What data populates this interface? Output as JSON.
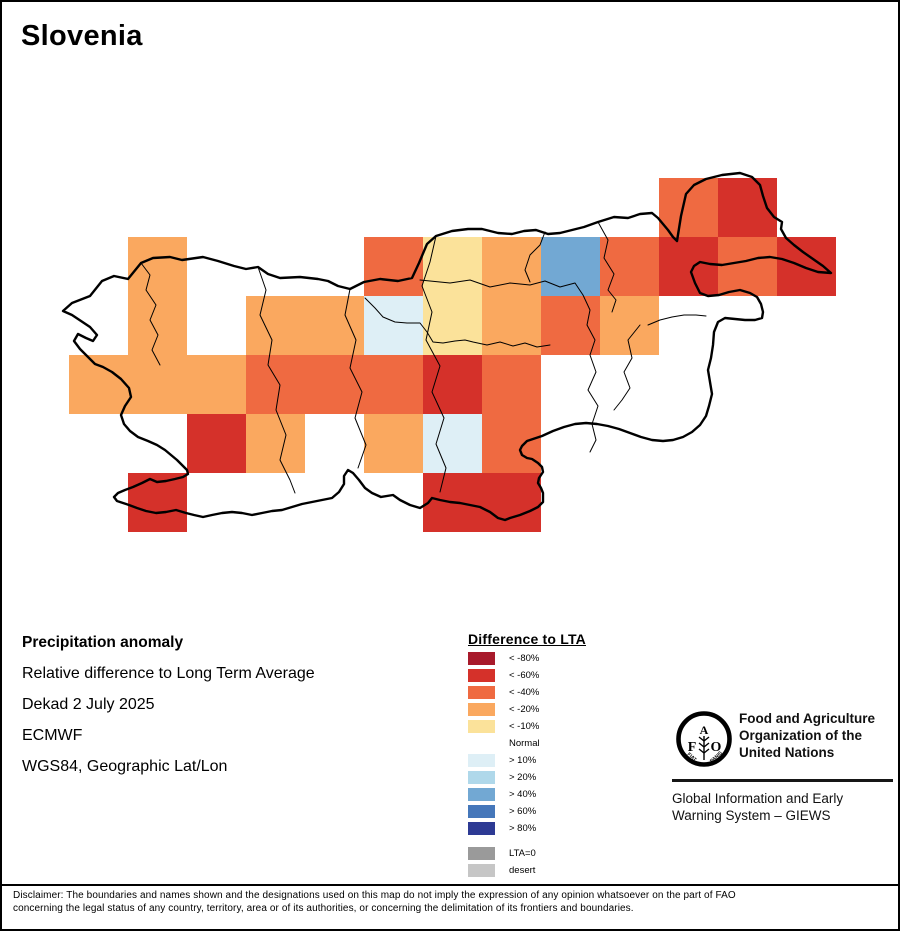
{
  "title": "Slovenia",
  "info": {
    "heading": "Precipitation anomaly",
    "subtitle": "Relative difference to Long Term Average",
    "dekad": "Dekad 2 July 2025",
    "source": "ECMWF",
    "projection": "WGS84, Geographic Lat/Lon"
  },
  "legend": {
    "title": "Difference to LTA",
    "items": [
      {
        "label": "< -80%",
        "class": "lt80"
      },
      {
        "label": "< -60%",
        "class": "lt60"
      },
      {
        "label": "< -40%",
        "class": "lt40"
      },
      {
        "label": "< -20%",
        "class": "lt20"
      },
      {
        "label": "< -10%",
        "class": "lt10"
      },
      {
        "label": "Normal",
        "class": "normal"
      },
      {
        "label": "> 10%",
        "class": "gt10"
      },
      {
        "label": "> 20%",
        "class": "gt20"
      },
      {
        "label": "> 40%",
        "class": "gt40"
      },
      {
        "label": "> 60%",
        "class": "gt60"
      },
      {
        "label": "> 80%",
        "class": "gt80"
      },
      {
        "label": "LTA=0",
        "class": "lta0",
        "gap_before": true
      },
      {
        "label": "desert",
        "class": "desert"
      }
    ]
  },
  "palette": {
    "lt80": "#A81A2B",
    "lt60": "#D5312A",
    "lt40": "#EF6A41",
    "lt20": "#FAA85F",
    "lt10": "#FBE29A",
    "normal": null,
    "gt10": "#DEEFF6",
    "gt20": "#AFD8EA",
    "gt40": "#72A8D3",
    "gt60": "#4577BA",
    "gt80": "#2D3A94",
    "lta0": "#9A9A9A",
    "desert": "#C6C6C6"
  },
  "map": {
    "cells": [
      {
        "col": 11,
        "row": 1,
        "class": "lt40"
      },
      {
        "col": 12,
        "row": 1,
        "class": "lt60"
      },
      {
        "col": 2,
        "row": 2,
        "class": "lt20"
      },
      {
        "col": 6,
        "row": 2,
        "class": "lt40"
      },
      {
        "col": 7,
        "row": 2,
        "class": "lt10"
      },
      {
        "col": 8,
        "row": 2,
        "class": "lt20"
      },
      {
        "col": 9,
        "row": 2,
        "class": "gt40"
      },
      {
        "col": 10,
        "row": 2,
        "class": "lt40"
      },
      {
        "col": 11,
        "row": 2,
        "class": "lt60"
      },
      {
        "col": 12,
        "row": 2,
        "class": "lt40"
      },
      {
        "col": 13,
        "row": 2,
        "class": "lt60"
      },
      {
        "col": 2,
        "row": 3,
        "class": "lt20"
      },
      {
        "col": 4,
        "row": 3,
        "class": "lt20"
      },
      {
        "col": 5,
        "row": 3,
        "class": "lt20"
      },
      {
        "col": 6,
        "row": 3,
        "class": "gt10"
      },
      {
        "col": 7,
        "row": 3,
        "class": "lt10"
      },
      {
        "col": 8,
        "row": 3,
        "class": "lt20"
      },
      {
        "col": 9,
        "row": 3,
        "class": "lt40"
      },
      {
        "col": 10,
        "row": 3,
        "class": "lt20"
      },
      {
        "col": 1,
        "row": 4,
        "class": "lt20"
      },
      {
        "col": 2,
        "row": 4,
        "class": "lt20"
      },
      {
        "col": 3,
        "row": 4,
        "class": "lt20"
      },
      {
        "col": 4,
        "row": 4,
        "class": "lt40"
      },
      {
        "col": 5,
        "row": 4,
        "class": "lt40"
      },
      {
        "col": 6,
        "row": 4,
        "class": "lt40"
      },
      {
        "col": 7,
        "row": 4,
        "class": "lt60"
      },
      {
        "col": 8,
        "row": 4,
        "class": "lt40"
      },
      {
        "col": 3,
        "row": 5,
        "class": "lt60"
      },
      {
        "col": 4,
        "row": 5,
        "class": "lt20"
      },
      {
        "col": 6,
        "row": 5,
        "class": "lt20"
      },
      {
        "col": 7,
        "row": 5,
        "class": "gt10"
      },
      {
        "col": 8,
        "row": 5,
        "class": "lt40"
      },
      {
        "col": 2,
        "row": 6,
        "class": "lt60"
      },
      {
        "col": 7,
        "row": 6,
        "class": "lt60"
      },
      {
        "col": 8,
        "row": 6,
        "class": "lt60"
      }
    ]
  },
  "fao": {
    "emblem": {
      "f": "F",
      "a": "A",
      "o": "O",
      "motto_left": "FIAT",
      "motto_right": "PANIS"
    },
    "org_line1": "Food and Agriculture",
    "org_line2": "Organization of the",
    "org_line3": "United Nations",
    "giews_line1": "Global Information and Early",
    "giews_line2": "Warning System – GIEWS"
  },
  "disclaimer": {
    "line1": "Disclaimer: The boundaries and names shown and the designations used on this map do not imply the expression of any opinion whatsoever on the part of FAO",
    "line2": "concerning the legal status of any country, territory, area or of its authorities, or concerning the delimitation of its frontiers and boundaries."
  }
}
